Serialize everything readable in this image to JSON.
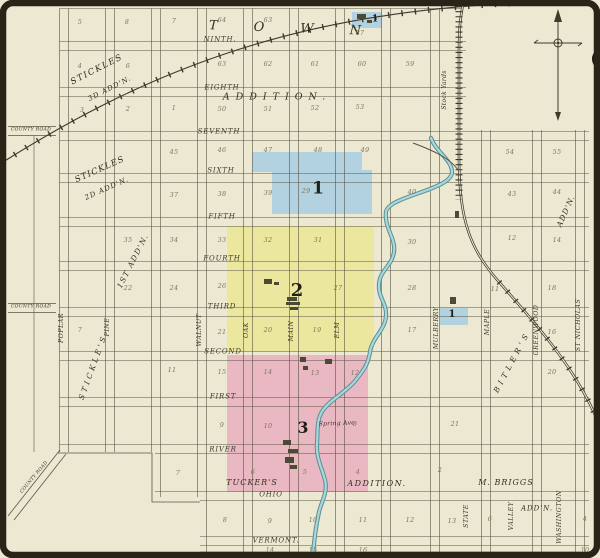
{
  "palette": {
    "paper": "#ece8d2",
    "ink": "#3f3b2c",
    "grid_line": "#5b5542",
    "district_blue": "#b2d2e1",
    "district_yellow": "#ece79e",
    "district_pink": "#eab8c3",
    "river_edge": "#569097",
    "river_fill": "#abd7d8",
    "railroad": "#3b382c",
    "frame": "#2a2318",
    "block_number": "#7d775e"
  },
  "streets_h": [
    {
      "label": "NINTH.",
      "x": 220,
      "y": 40
    },
    {
      "label": "EIGHTH",
      "x": 222,
      "y": 88
    },
    {
      "label": "SEVENTH",
      "x": 219,
      "y": 132
    },
    {
      "label": "SIXTH",
      "x": 221,
      "y": 171
    },
    {
      "label": "FIFTH",
      "x": 222,
      "y": 217
    },
    {
      "label": "FOURTH",
      "x": 222,
      "y": 259
    },
    {
      "label": "THIRD",
      "x": 222,
      "y": 307
    },
    {
      "label": "SECOND",
      "x": 223,
      "y": 352
    },
    {
      "label": "FIRST",
      "x": 223,
      "y": 397
    },
    {
      "label": "RIVER",
      "x": 223,
      "y": 450
    },
    {
      "label": "OHIO",
      "x": 271,
      "y": 495
    },
    {
      "label": "VERMONT.",
      "x": 276,
      "y": 541
    }
  ],
  "streets_v": [
    {
      "label": "POPLAR",
      "x": 62,
      "y": 328
    },
    {
      "label": "PINE",
      "x": 108,
      "y": 327
    },
    {
      "label": "WALNUT",
      "x": 200,
      "y": 330
    },
    {
      "label": "OAK",
      "x": 247,
      "y": 330
    },
    {
      "label": "MAIN",
      "x": 292,
      "y": 331
    },
    {
      "label": "ELM",
      "x": 338,
      "y": 330
    },
    {
      "label": "MULBERRY",
      "x": 437,
      "y": 328
    },
    {
      "label": "MAPLE",
      "x": 488,
      "y": 322
    },
    {
      "label": "GREENWOOD",
      "x": 537,
      "y": 330
    },
    {
      "label": "ST NICHOLAS",
      "x": 579,
      "y": 325
    },
    {
      "label": "STATE",
      "x": 467,
      "y": 516
    },
    {
      "label": "VALLEY",
      "x": 512,
      "y": 516
    },
    {
      "label": "WASHINGTON",
      "x": 560,
      "y": 517
    }
  ],
  "area_labels": [
    {
      "name": "town-label",
      "label": "TOWN",
      "x": 303,
      "y": 29,
      "rot": 2,
      "size": 13,
      "ls": 36
    },
    {
      "name": "addition-label",
      "label": "ADDITION.",
      "x": 277,
      "y": 97,
      "rot": 0,
      "size": 9.5,
      "ls": 6
    },
    {
      "name": "stickles-3d-name",
      "label": "STICKLES",
      "x": 97,
      "y": 70,
      "rot": -27,
      "size": 8.5,
      "ls": 1.5
    },
    {
      "name": "stickles-3d-addn",
      "label": "3D ADD'N.",
      "x": 110,
      "y": 89,
      "rot": -27,
      "size": 7,
      "ls": 1
    },
    {
      "name": "stickles-2d-name",
      "label": "STICKLES",
      "x": 100,
      "y": 170,
      "rot": -24,
      "size": 8.5,
      "ls": 1
    },
    {
      "name": "stickles-2d-addn",
      "label": "2D ADD'N.",
      "x": 107,
      "y": 189,
      "rot": -24,
      "size": 7,
      "ls": 1
    },
    {
      "name": "first-addn-label",
      "label": "1ST ADD'N.",
      "x": 133,
      "y": 261,
      "rot": -63,
      "size": 7.5,
      "ls": 1.5
    },
    {
      "name": "stickles-label-sw",
      "label": "STICKLE'S",
      "x": 93,
      "y": 367,
      "rot": -70,
      "size": 7.5,
      "ls": 3
    },
    {
      "name": "tuckers-label",
      "label": "TUCKER'S",
      "x": 252,
      "y": 483,
      "rot": 0,
      "size": 8,
      "ls": 1
    },
    {
      "name": "tuckers-addition-label",
      "label": "ADDITION.",
      "x": 377,
      "y": 484,
      "rot": 0,
      "size": 8,
      "ls": 1.5
    },
    {
      "name": "m-briggs-label",
      "label": "M. BRIGGS",
      "x": 506,
      "y": 483,
      "rot": 0,
      "size": 8,
      "ls": 1
    },
    {
      "name": "m-briggs-addn",
      "label": "ADD'N.",
      "x": 537,
      "y": 509,
      "rot": 0,
      "size": 7,
      "ls": 1
    },
    {
      "name": "bitlers-label",
      "label": "BITLER'S",
      "x": 512,
      "y": 362,
      "rot": -62,
      "size": 7.5,
      "ls": 4
    },
    {
      "name": "bitlers-addn",
      "label": "ADD'N.",
      "x": 566,
      "y": 211,
      "rot": -66,
      "size": 7.5,
      "ls": 1
    },
    {
      "name": "stock-yards-label",
      "label": "Stock Yards",
      "x": 445,
      "y": 90,
      "rot": -90,
      "size": 6,
      "ls": 0.3
    },
    {
      "name": "avenue-label",
      "label": "Spring Ave.",
      "x": 338,
      "y": 424,
      "rot": -2,
      "size": 6,
      "ls": 0.3
    },
    {
      "name": "county-road-label-1",
      "label": "COUNTY ROAD",
      "x": 31,
      "y": 131,
      "rot": 0,
      "size": 4.6,
      "ls": 0.3
    },
    {
      "name": "county-road-label-2",
      "label": "COUNTY ROAD",
      "x": 31,
      "y": 308,
      "rot": 0,
      "size": 4.6,
      "ls": 0.3
    },
    {
      "name": "county-road-label-3",
      "label": "COUNTY ROAD",
      "x": 35,
      "y": 478,
      "rot": -50,
      "size": 4.6,
      "ls": 0.3
    }
  ],
  "district_markers": [
    {
      "label": "1",
      "x": 318,
      "y": 189,
      "size": 17
    },
    {
      "label": "2",
      "x": 297,
      "y": 291,
      "size": 18
    },
    {
      "label": "3",
      "x": 303,
      "y": 428,
      "size": 16
    },
    {
      "label": "1",
      "x": 452,
      "y": 315,
      "size": 10
    },
    {
      "label": "1",
      "x": 375,
      "y": 20,
      "size": 9
    }
  ],
  "block_numbers": [
    {
      "n": "5",
      "x": 80,
      "y": 22
    },
    {
      "n": "8",
      "x": 127,
      "y": 22
    },
    {
      "n": "7",
      "x": 174,
      "y": 21
    },
    {
      "n": "64",
      "x": 222,
      "y": 20
    },
    {
      "n": "63",
      "x": 268,
      "y": 20
    },
    {
      "n": "87",
      "x": 360,
      "y": 33
    },
    {
      "n": "4",
      "x": 80,
      "y": 66
    },
    {
      "n": "6",
      "x": 128,
      "y": 66
    },
    {
      "n": "63",
      "x": 222,
      "y": 64
    },
    {
      "n": "62",
      "x": 268,
      "y": 64
    },
    {
      "n": "61",
      "x": 315,
      "y": 64
    },
    {
      "n": "60",
      "x": 362,
      "y": 64
    },
    {
      "n": "59",
      "x": 410,
      "y": 64
    },
    {
      "n": "3",
      "x": 82,
      "y": 110
    },
    {
      "n": "2",
      "x": 128,
      "y": 109
    },
    {
      "n": "1",
      "x": 174,
      "y": 108
    },
    {
      "n": "50",
      "x": 222,
      "y": 109
    },
    {
      "n": "51",
      "x": 268,
      "y": 109
    },
    {
      "n": "52",
      "x": 315,
      "y": 108
    },
    {
      "n": "53",
      "x": 360,
      "y": 107
    },
    {
      "n": "45",
      "x": 174,
      "y": 152
    },
    {
      "n": "46",
      "x": 222,
      "y": 150
    },
    {
      "n": "47",
      "x": 268,
      "y": 150
    },
    {
      "n": "48",
      "x": 318,
      "y": 150
    },
    {
      "n": "49",
      "x": 365,
      "y": 150
    },
    {
      "n": "54",
      "x": 510,
      "y": 152
    },
    {
      "n": "55",
      "x": 557,
      "y": 152
    },
    {
      "n": "37",
      "x": 174,
      "y": 195
    },
    {
      "n": "38",
      "x": 222,
      "y": 194
    },
    {
      "n": "39",
      "x": 268,
      "y": 193
    },
    {
      "n": "29",
      "x": 306,
      "y": 191
    },
    {
      "n": "40",
      "x": 412,
      "y": 192
    },
    {
      "n": "43",
      "x": 512,
      "y": 194
    },
    {
      "n": "44",
      "x": 557,
      "y": 192
    },
    {
      "n": "35",
      "x": 128,
      "y": 240
    },
    {
      "n": "34",
      "x": 174,
      "y": 240
    },
    {
      "n": "33",
      "x": 222,
      "y": 240
    },
    {
      "n": "32",
      "x": 268,
      "y": 240
    },
    {
      "n": "31",
      "x": 318,
      "y": 240
    },
    {
      "n": "30",
      "x": 412,
      "y": 242
    },
    {
      "n": "12",
      "x": 512,
      "y": 238
    },
    {
      "n": "14",
      "x": 557,
      "y": 240
    },
    {
      "n": "22",
      "x": 128,
      "y": 288
    },
    {
      "n": "24",
      "x": 174,
      "y": 288
    },
    {
      "n": "26",
      "x": 222,
      "y": 286
    },
    {
      "n": "27",
      "x": 338,
      "y": 288
    },
    {
      "n": "28",
      "x": 412,
      "y": 288
    },
    {
      "n": "11",
      "x": 495,
      "y": 289
    },
    {
      "n": "18",
      "x": 552,
      "y": 288
    },
    {
      "n": "7",
      "x": 80,
      "y": 330
    },
    {
      "n": "21",
      "x": 222,
      "y": 332
    },
    {
      "n": "20",
      "x": 268,
      "y": 330
    },
    {
      "n": "19",
      "x": 317,
      "y": 330
    },
    {
      "n": "17",
      "x": 412,
      "y": 330
    },
    {
      "n": "16",
      "x": 552,
      "y": 332
    },
    {
      "n": "11",
      "x": 172,
      "y": 370
    },
    {
      "n": "15",
      "x": 222,
      "y": 372
    },
    {
      "n": "14",
      "x": 268,
      "y": 372
    },
    {
      "n": "13",
      "x": 315,
      "y": 373
    },
    {
      "n": "12",
      "x": 355,
      "y": 373
    },
    {
      "n": "20",
      "x": 552,
      "y": 372
    },
    {
      "n": "9",
      "x": 222,
      "y": 425
    },
    {
      "n": "10",
      "x": 268,
      "y": 426
    },
    {
      "n": "8",
      "x": 355,
      "y": 424
    },
    {
      "n": "21",
      "x": 455,
      "y": 424
    },
    {
      "n": "7",
      "x": 178,
      "y": 473
    },
    {
      "n": "6",
      "x": 253,
      "y": 472
    },
    {
      "n": "5",
      "x": 305,
      "y": 472
    },
    {
      "n": "4",
      "x": 358,
      "y": 472
    },
    {
      "n": "2",
      "x": 440,
      "y": 470
    },
    {
      "n": "8",
      "x": 225,
      "y": 520
    },
    {
      "n": "9",
      "x": 270,
      "y": 521
    },
    {
      "n": "10",
      "x": 313,
      "y": 520
    },
    {
      "n": "11",
      "x": 363,
      "y": 520
    },
    {
      "n": "12",
      "x": 410,
      "y": 520
    },
    {
      "n": "13",
      "x": 452,
      "y": 521
    },
    {
      "n": "6",
      "x": 490,
      "y": 519
    },
    {
      "n": "4",
      "x": 585,
      "y": 519
    },
    {
      "n": "14",
      "x": 270,
      "y": 550
    },
    {
      "n": "15",
      "x": 313,
      "y": 550
    },
    {
      "n": "16",
      "x": 363,
      "y": 550
    },
    {
      "n": "10",
      "x": 585,
      "y": 550
    }
  ],
  "regions": {
    "blue_main": [
      [
        252,
        152,
        110,
        20
      ],
      [
        272,
        170,
        100,
        44
      ]
    ],
    "blue_small_top": [
      352,
      12,
      30,
      16
    ],
    "blue_small_right": [
      440,
      308,
      28,
      17
    ],
    "yellow": [
      227,
      226,
      147,
      125
    ],
    "pink": [
      227,
      355,
      141,
      137
    ]
  },
  "buildings": [
    [
      264,
      279,
      8,
      5
    ],
    [
      274,
      282,
      5,
      3
    ],
    [
      287,
      297,
      10,
      4
    ],
    [
      286,
      302,
      14,
      3
    ],
    [
      290,
      307,
      8,
      3
    ],
    [
      300,
      357,
      6,
      5
    ],
    [
      325,
      359,
      7,
      5
    ],
    [
      303,
      366,
      5,
      4
    ],
    [
      283,
      440,
      8,
      5
    ],
    [
      288,
      449,
      10,
      4
    ],
    [
      285,
      457,
      9,
      6
    ],
    [
      290,
      465,
      7,
      4
    ],
    [
      450,
      297,
      6,
      7
    ],
    [
      455,
      211,
      4,
      7
    ],
    [
      357,
      14,
      9,
      5
    ],
    [
      367,
      20,
      5,
      3
    ]
  ]
}
